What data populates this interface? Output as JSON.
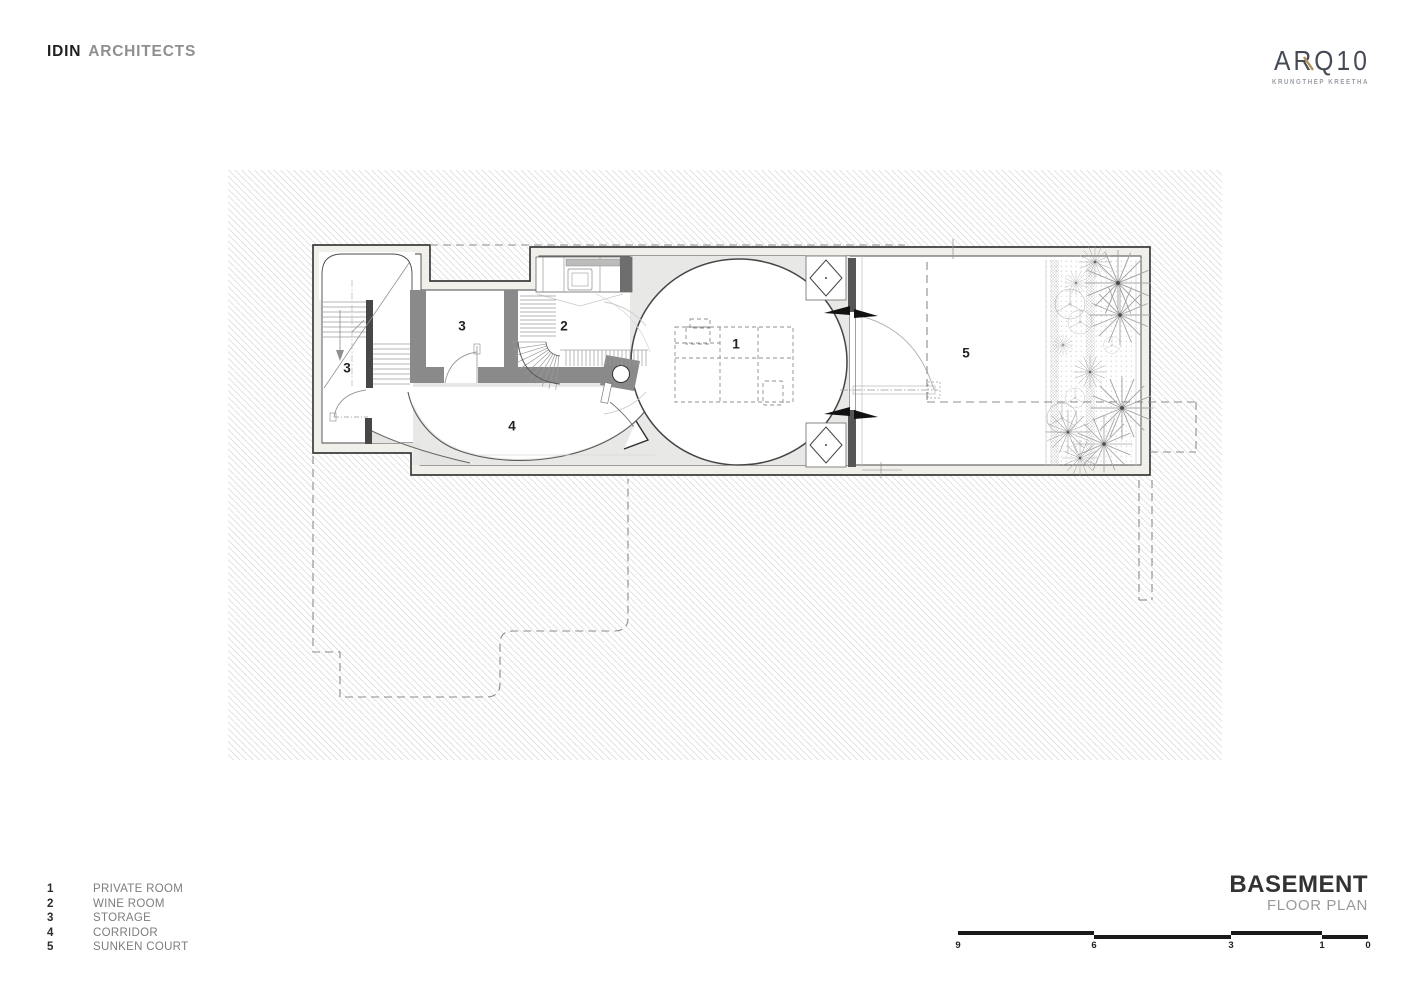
{
  "header": {
    "brand": {
      "primary": "IDIN",
      "secondary": "ARCHITECTS"
    }
  },
  "project_logo": {
    "name": "ARQ10",
    "subtitle": "KRUNGTHEP KREETHA",
    "accent_color": "#b3925a",
    "text_color": "#454b55"
  },
  "legend": {
    "items": [
      {
        "number": "1",
        "label": "PRIVATE ROOM"
      },
      {
        "number": "2",
        "label": "WINE ROOM"
      },
      {
        "number": "3",
        "label": "STORAGE"
      },
      {
        "number": "4",
        "label": "CORRIDOR"
      },
      {
        "number": "5",
        "label": "SUNKEN COURT"
      }
    ]
  },
  "plan": {
    "room_labels": [
      {
        "text": "3"
      },
      {
        "text": "3"
      },
      {
        "text": "2"
      },
      {
        "text": "1"
      },
      {
        "text": "4"
      },
      {
        "text": "5"
      }
    ]
  },
  "title_block": {
    "title": "BASEMENT",
    "subtitle": "FLOOR PLAN"
  },
  "scale_bar": {
    "numbers": [
      "9",
      "6",
      "3",
      "1",
      "0"
    ]
  },
  "colors": {
    "wall_dark": "#4f4f4f",
    "wall_mid": "#8a8a8a",
    "hatch": "#d7d7d7",
    "accent_gold": "#b3925a"
  }
}
